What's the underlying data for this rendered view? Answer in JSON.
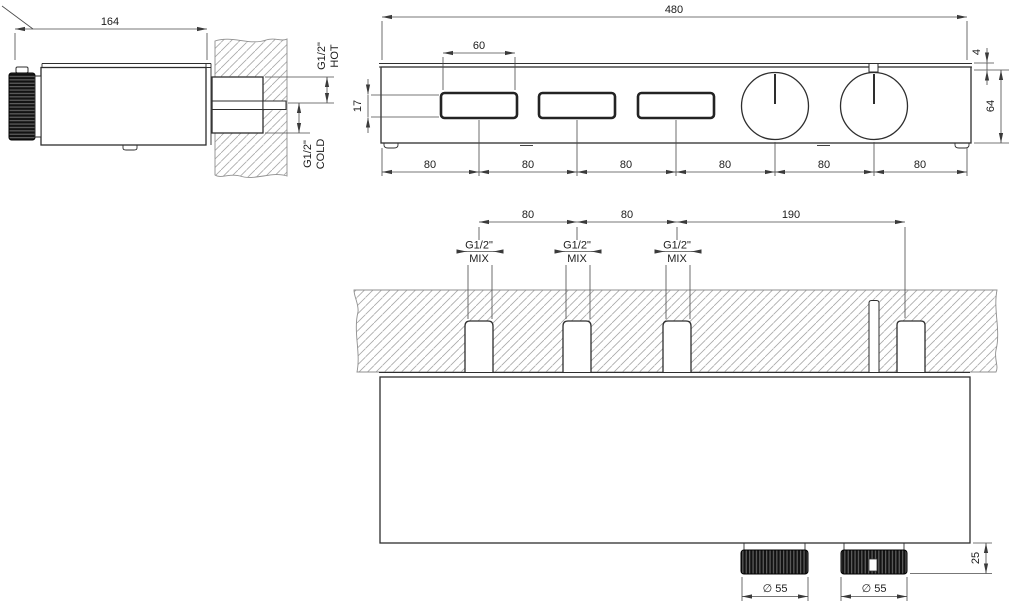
{
  "drawing_title": "thermostatic-mixer-technical-drawing",
  "colors": {
    "line": "#2e2e2e",
    "dimension": "#4a4a4a",
    "hatch": "#a8a8a8",
    "knob": "#121212",
    "background": "#ffffff"
  },
  "views": {
    "side": {
      "overall_length": "164",
      "hot": {
        "thread": "G1/2\"",
        "label": "HOT"
      },
      "cold": {
        "thread": "G1/2\"",
        "label": "COLD"
      }
    },
    "front": {
      "overall_width": "480",
      "button_width": "60",
      "button_height": "17",
      "plate_offset": "4",
      "body_height": "64",
      "spacings": [
        "80",
        "80",
        "80",
        "80",
        "80",
        "80"
      ]
    },
    "plan": {
      "spacings": [
        "80",
        "80",
        "190"
      ],
      "ports": [
        {
          "thread": "G1/2\"",
          "flow": "MIX"
        },
        {
          "thread": "G1/2\"",
          "flow": "MIX"
        },
        {
          "thread": "G1/2\"",
          "flow": "MIX"
        }
      ],
      "knob_diameter_1": "∅ 55",
      "knob_diameter_2": "∅ 55",
      "knob_projection": "25"
    }
  }
}
